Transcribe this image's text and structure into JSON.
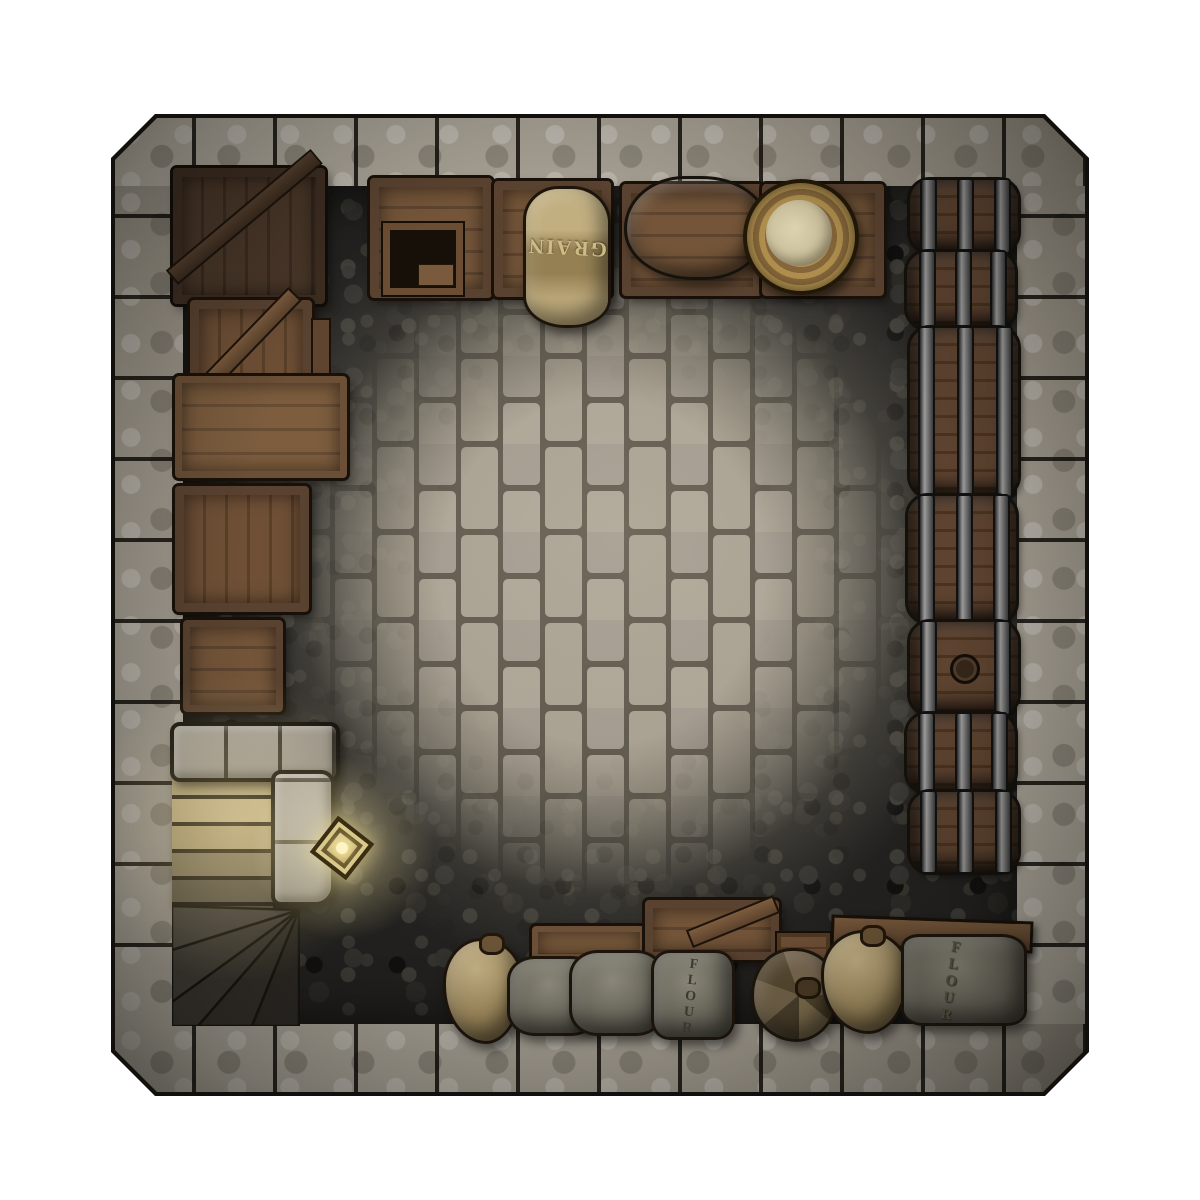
{
  "scene": {
    "name": "Stone cellar storeroom",
    "view": "top-down battlemap",
    "background": "#ffffff"
  },
  "labels": {
    "grain_sack": "GRAIN",
    "flour_sack_center": "FLOUR",
    "flour_sack_right": "FLOUR"
  },
  "palette": {
    "wall_stone": "#a69f93",
    "wall_joint": "#14120e",
    "floor_dark_cobble": "#232220",
    "floor_mid_cobble": "#56534a",
    "floor_brick": "#a49c8c",
    "mortar": "#575044",
    "crate_wood": "#6f5036",
    "crate_frame": "#5a4230",
    "dark_crate": "#3d2d21",
    "barrel_wood": "#5d4330",
    "metal_band": "#9b9b9b",
    "burlap": "#b3a271",
    "gray_sack": "#6b685c",
    "basket": "#b08f4e",
    "basket_fill": "#dbd1af",
    "stair_light": "#cbb685",
    "stair_dark": "#34302a",
    "lantern_glow": "#f4e396",
    "outline": "#12100d"
  },
  "objects": [
    "stone-perimeter-wall",
    "dark-cobblestone-floor",
    "flagstone-brick-floor",
    "dark-corner-crate",
    "braced-crate",
    "long-plank-table",
    "vertical-plank-crate",
    "small-crate",
    "stone-stair-balustrade",
    "straight-stairs-descending",
    "winder-stairs",
    "wall-lantern",
    "prep-table-with-open-box",
    "grain-crate",
    "grain-sack",
    "cloth-bundle-crate",
    "gray-cloth-bundle",
    "basket-crate",
    "bread-basket",
    "barrel-row-of-seven",
    "bunged-barrel",
    "shelf-plank",
    "tied-burlap-sack-right",
    "flour-sack-right",
    "low-bench",
    "x-braced-crate",
    "small-plank-crate",
    "tied-burlap-sack-center",
    "gray-sack-pair",
    "flour-sack-center",
    "brown-tied-sack"
  ]
}
